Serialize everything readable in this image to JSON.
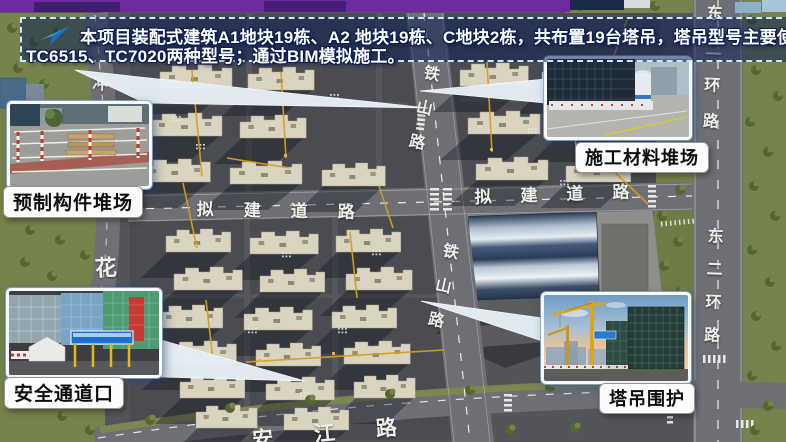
{
  "banner": {
    "line1": "本项目装配式建筑A1地块19栋、A2 地块19栋、C地块2栋，共布置19台塔吊，塔吊型号主要使用",
    "line2": "TC6515、TC7020两种型号；通过BIM模拟施工。",
    "icon": "paper-plane-icon"
  },
  "callouts": {
    "prefab_yard": {
      "label": "预制构件堆场"
    },
    "material_yard": {
      "label": "施工材料堆场"
    },
    "safety_gate": {
      "label": "安全通道口"
    },
    "crane_fence": {
      "label": "塔吊围护"
    }
  },
  "roads": {
    "tieshan_top": "铁山路",
    "tieshan_mid": "铁山路",
    "nijian_left": "拟建道路",
    "nijian_right": "拟建道路",
    "donger_top": "东二环路",
    "donger_bottom": "东二环路",
    "hua": "花",
    "chong": "冲",
    "anjiang": "安江路"
  },
  "colors": {
    "accent_purple": "#6d2c9e",
    "banner_border": "#cde6ff",
    "crane_line": "#d4a01c",
    "building_fill": "#d9d3c0",
    "road_gray": "#6f7075",
    "forest_green": "#76834c"
  }
}
